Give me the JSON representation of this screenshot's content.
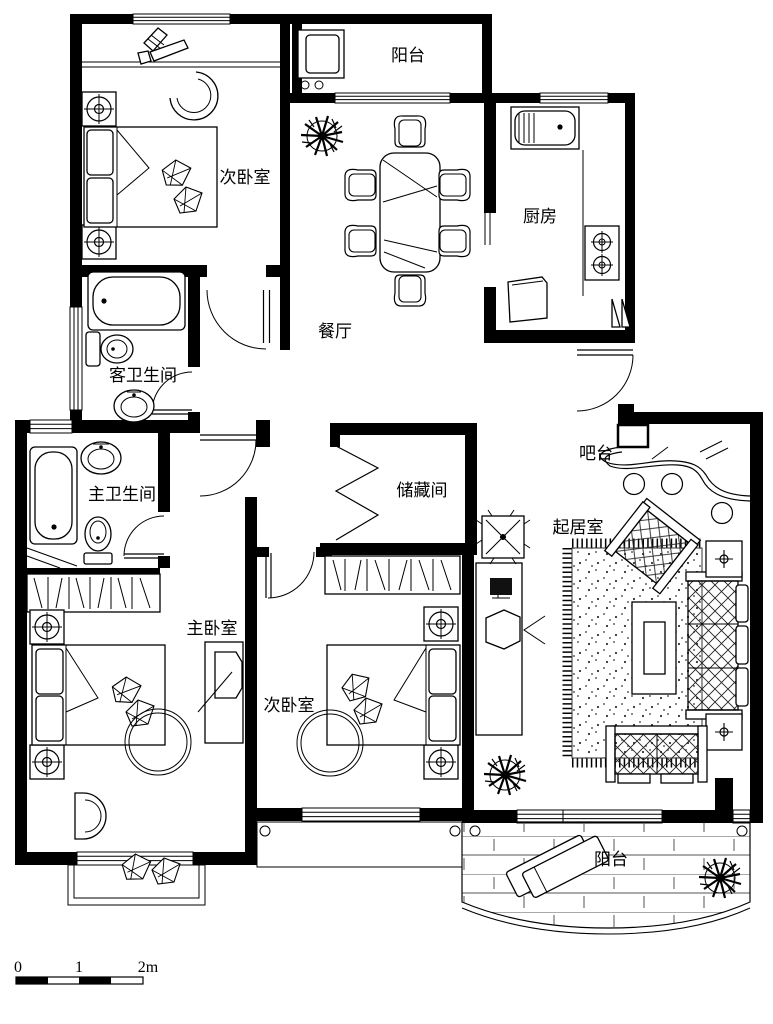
{
  "plan": {
    "rooms": {
      "balcony_top": "阳台",
      "bedroom_top": "次卧室",
      "kitchen": "厨房",
      "dining": "餐厅",
      "guest_bath": "客卫生间",
      "master_bath": "主卫生间",
      "storage": "储藏间",
      "bar": "吧台",
      "living": "起居室",
      "master_bedroom": "主卧室",
      "bedroom_bottom": "次卧室",
      "balcony_bottom": "阳台"
    },
    "scale": {
      "t0": "0",
      "t1": "1",
      "t2": "2m"
    },
    "colors": {
      "wall": "#000000",
      "line": "#1a1a1a",
      "background": "#ffffff"
    }
  }
}
